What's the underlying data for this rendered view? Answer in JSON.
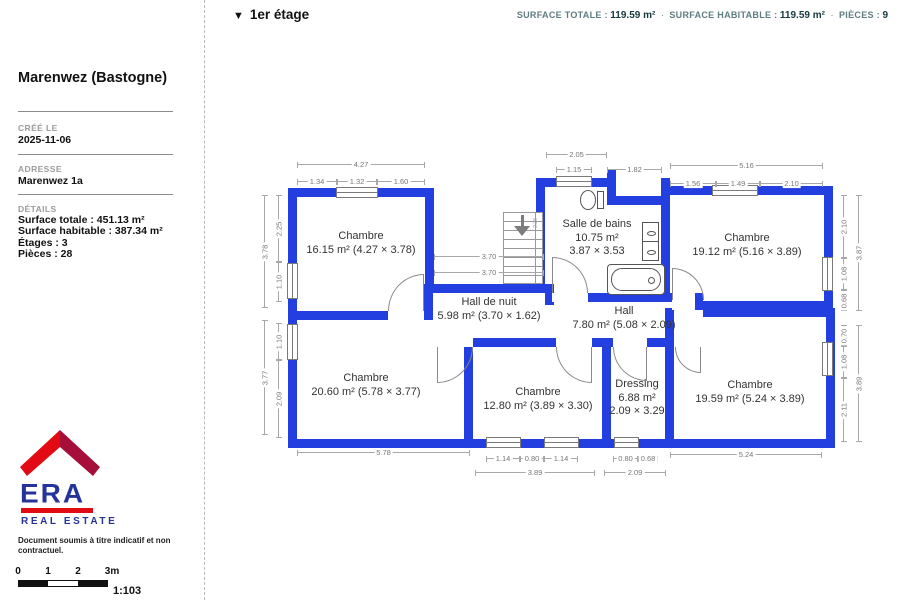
{
  "header": {
    "marker": "▼",
    "floor": "1er étage"
  },
  "stats_bar": {
    "separator": "·",
    "items": [
      {
        "label": "SURFACE TOTALE :",
        "value": "119.59 m²"
      },
      {
        "label": "SURFACE HABITABLE :",
        "value": "119.59 m²"
      },
      {
        "label": "PIÈCES :",
        "value": "9"
      }
    ]
  },
  "sidebar": {
    "title": "Marenwez (Bastogne)",
    "created_label": "CRÉÉ LE",
    "created_value": "2025-11-06",
    "address_label": "ADRESSE",
    "address_value": "Marenwez 1a",
    "details_label": "DÉTAILS",
    "details": [
      "Surface totale : 451.13 m²",
      "Surface habitable : 387.34 m²",
      "Étages : 3",
      "Pièces : 28"
    ]
  },
  "logo": {
    "brand": "ERA",
    "subtitle": "REAL ESTATE",
    "roof_left_color": "#e30b13",
    "roof_right_color": "#a50f3a",
    "blue": "#25339b",
    "red": "#e30b13"
  },
  "disclaimer": "Document soumis à titre indicatif et non contractuel.",
  "scale_bar": {
    "ticks": [
      "0",
      "1",
      "2",
      "3m"
    ],
    "ratio": "1:103"
  },
  "plan": {
    "wall_color": "#233fdf",
    "rooms": {
      "chambre1": {
        "name": "Chambre",
        "detail": "16.15 m² (4.27 × 3.78)"
      },
      "salle_de_bains": {
        "name": "Salle de bains",
        "area": "10.75 m²",
        "dims": "3.87 × 3.53"
      },
      "chambre2": {
        "name": "Chambre",
        "detail": "19.12 m² (5.16 × 3.89)"
      },
      "hall_de_nuit": {
        "name": "Hall de nuit",
        "detail": "5.98 m² (3.70 × 1.62)"
      },
      "hall": {
        "name": "Hall",
        "detail": "7.80 m² (5.08 × 2.09)"
      },
      "chambre3": {
        "name": "Chambre",
        "detail": "20.60 m² (5.78 × 3.77)"
      },
      "chambre4": {
        "name": "Chambre",
        "detail": "12.80 m² (3.89 × 3.30)"
      },
      "dressing": {
        "name": "Dressing",
        "area": "6.88 m²",
        "dims": "2.09 × 3.29"
      },
      "chambre5": {
        "name": "Chambre",
        "detail": "19.59 m² (5.24 × 3.89)"
      }
    },
    "dims": {
      "t1": "4.27",
      "t2": "1.34",
      "t3": "1.32",
      "t4": "1.60",
      "t5": "2.05",
      "t6": "1.15",
      "t7": "1.82",
      "t8": "5.16",
      "t9": "1.56",
      "t10": "1.49",
      "t11": "2.10",
      "l1": "3.78",
      "l2": "2.25",
      "l3": "1.10",
      "l4": "3.77",
      "l5": "1.10",
      "l6": "2.09",
      "r1": "3.87",
      "r2": "2.10",
      "r3": "1.08",
      "r4": "0.68",
      "r5": "3.89",
      "r6": "0.70",
      "r7": "1.08",
      "r8": "2.11",
      "b1": "5.78",
      "b2": "1.14",
      "b3": "0.80",
      "b4": "1.14",
      "b5": "3.89",
      "b6": "0.80",
      "b7": "0.68",
      "b8": "2.09",
      "b9": "5.24",
      "m1": "3.70",
      "m2": "3.70"
    },
    "stairs_label": "2.28"
  }
}
